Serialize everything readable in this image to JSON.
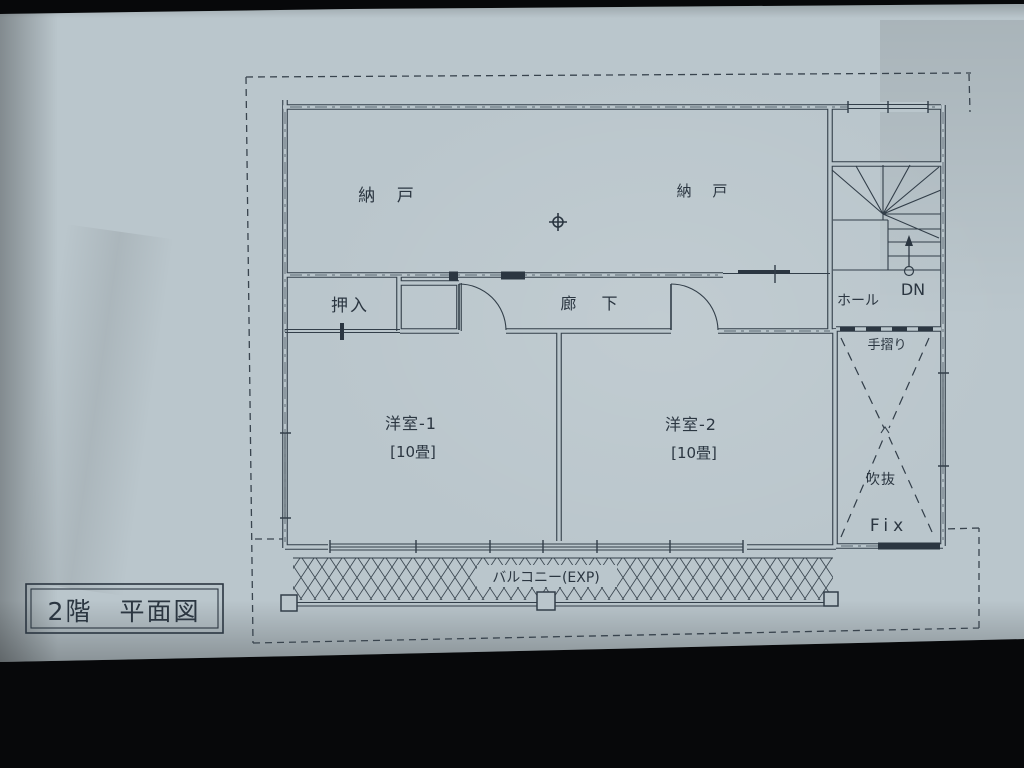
{
  "photo": {
    "background_color": "#07080a",
    "paper_color": "#bac6cc",
    "ink_color": "#323e49"
  },
  "title_block": {
    "text": "2階　平面図"
  },
  "labels": {
    "storage_left": "納 戸",
    "storage_right": "納 戸",
    "closet": "押入",
    "corridor": "廊 下",
    "hall": "ホール",
    "stairs_down": "DN",
    "handrail": "手摺り",
    "void": "吹抜",
    "fixed_window": "Fix",
    "room1_name": "洋室-1",
    "room1_size": "[10畳]",
    "room2_name": "洋室-2",
    "room2_size": "[10畳]",
    "balcony": "バルコニー(EXP)"
  },
  "symbols": {
    "survey_marker": "crosshair-circle",
    "stair_direction": "up-arrow-with-circle",
    "void_marking": "dashed-bowtie-cross",
    "balcony_marking": "diamond-lattice-hatch",
    "boundary": "dashed-property-line"
  }
}
